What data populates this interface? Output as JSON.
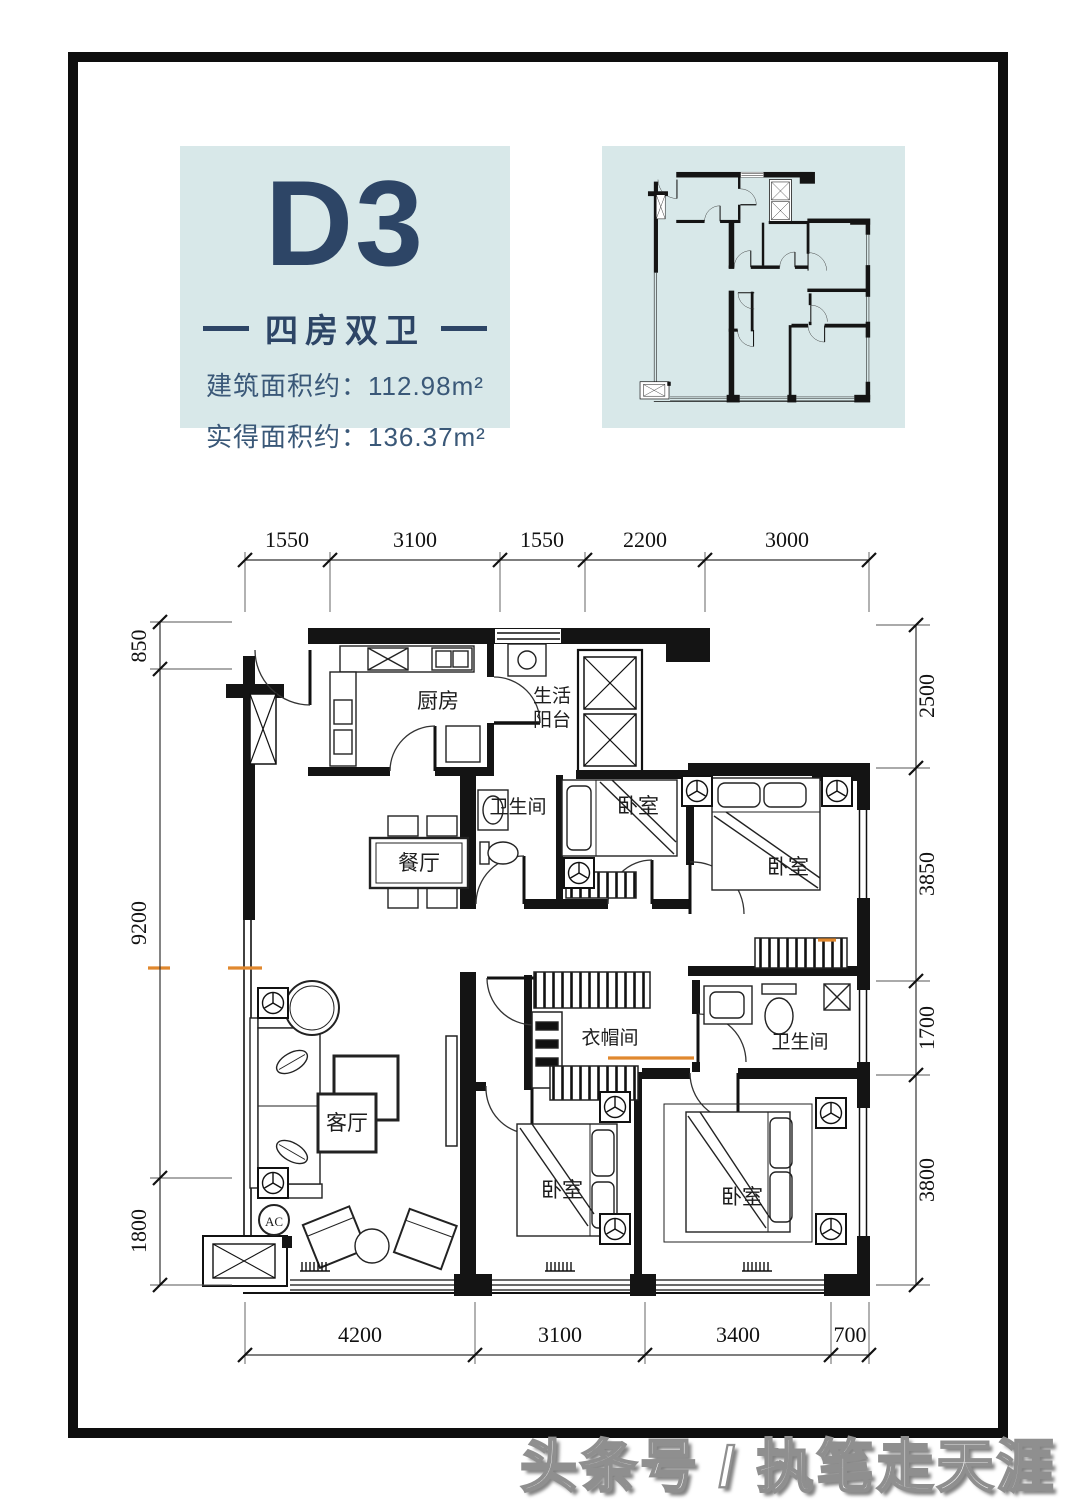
{
  "header": {
    "unit_code": "D3",
    "layout_type": "四房双卫",
    "area_built": "建筑面积约：112.98m²",
    "area_actual": "实得面积约：136.37m²"
  },
  "plan": {
    "rooms": {
      "kitchen": "厨房",
      "balcony_line1": "生活",
      "balcony_line2": "阳台",
      "bathroom": "卫生间",
      "bedroom": "卧室",
      "dining": "餐厅",
      "living": "客厅",
      "cloakroom": "衣帽间",
      "ac": "AC"
    },
    "dims": {
      "top": [
        "1550",
        "3100",
        "1550",
        "2200",
        "3000"
      ],
      "bottom": [
        "4200",
        "3100",
        "3400",
        "700"
      ],
      "left": [
        "850",
        "9200",
        "1800"
      ],
      "right": [
        "2500",
        "3850",
        "1700",
        "3800"
      ]
    }
  },
  "watermark": "头条号 / 执笔走天涯",
  "colors": {
    "panel-bg": "#d8e8e9",
    "navy": "#2d4566",
    "navy-soft": "#3a5878",
    "wall": "#141414",
    "accent-orange": "#e0882e"
  }
}
